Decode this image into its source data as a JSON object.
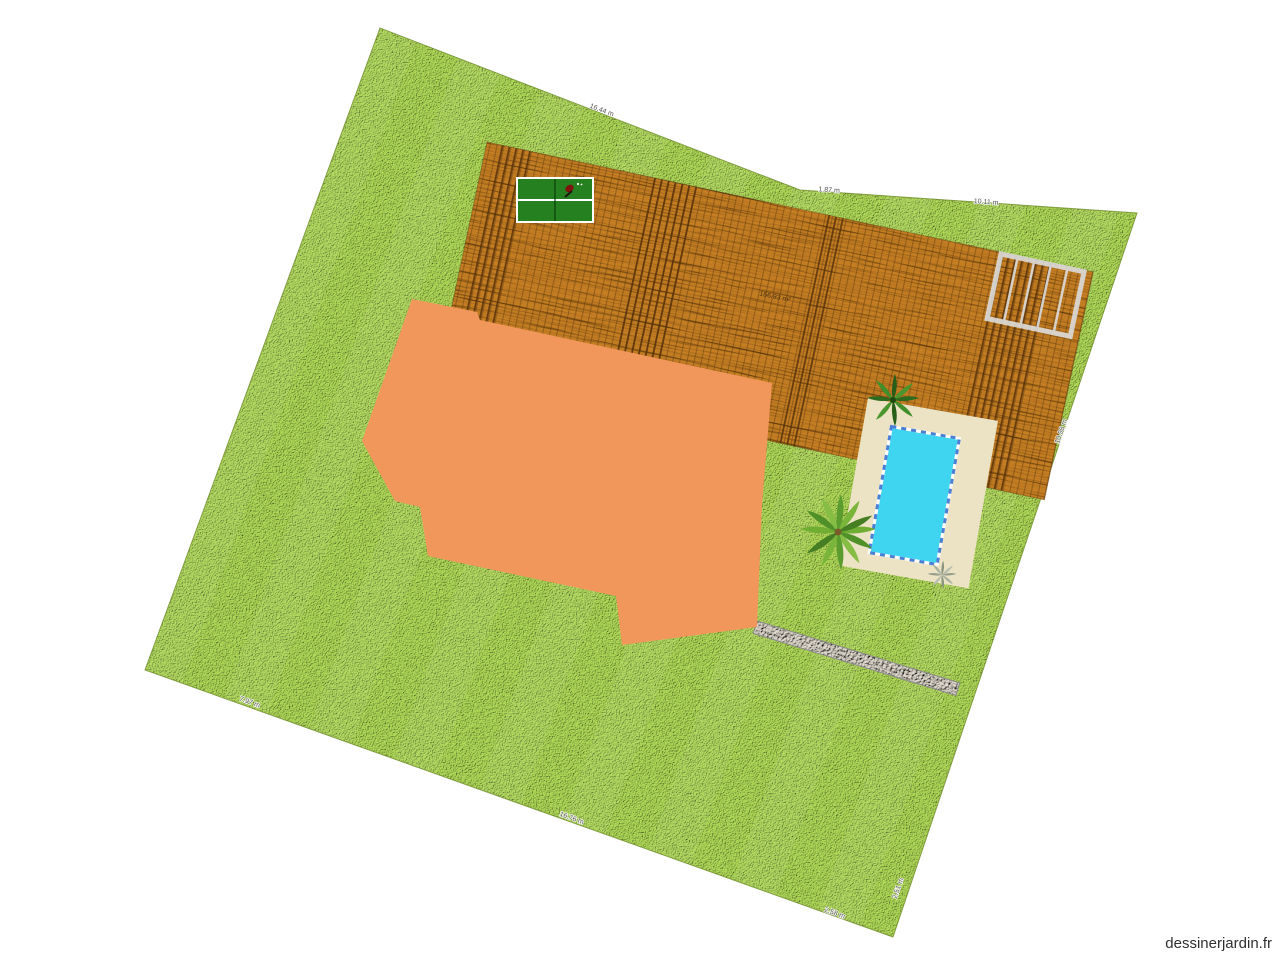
{
  "canvas": {
    "watermark": "dessinerjardin.fr"
  },
  "colors": {
    "grass": "#a6cd52",
    "wood": "#c07a24",
    "plank_line": "#5f3a0e",
    "building": "#f2975c",
    "pool_water": "#3fd4f0",
    "pool_terrace": "#ece3c4",
    "pool_edge": "#4a7fd6",
    "table": "#25801f",
    "pergola": "#dcdcdc",
    "gravel": "#ded8cc",
    "label": "#4a4a4a"
  },
  "labels": {
    "deck_area": "166.93 m²",
    "boundary": [
      {
        "text": "16.44 m"
      },
      {
        "text": "1.87 m"
      },
      {
        "text": "10.11 m"
      },
      {
        "text": "10.98 m"
      },
      {
        "text": "2.51 m"
      },
      {
        "text": "2.58 m"
      },
      {
        "text": "16.76 m"
      },
      {
        "text": "7.97 m"
      }
    ]
  }
}
